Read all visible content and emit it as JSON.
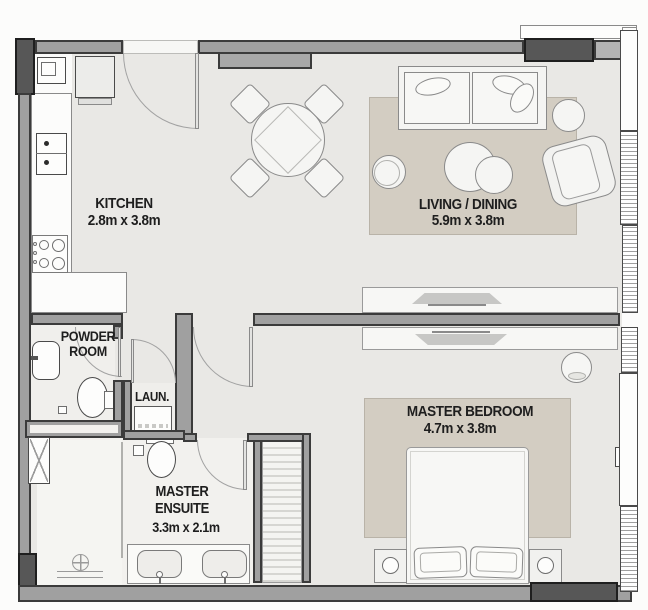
{
  "plan_title": "one-bedroom-apartment-floor-plan",
  "labels": {
    "kitchen": {
      "name": "KITCHEN",
      "dims": "2.8m x 3.8m"
    },
    "living_dining": {
      "name": "LIVING / DINING",
      "dims": "5.9m x 3.8m"
    },
    "powder_room": {
      "name_line1": "POWDER",
      "name_line2": "ROOM"
    },
    "laundry": {
      "name": "LAUN."
    },
    "master_ensuite": {
      "name_line1": "MASTER",
      "name_line2": "ENSUITE",
      "dims": "3.3m x 2.1m"
    },
    "master_bedroom": {
      "name": "MASTER BEDROOM",
      "dims": "4.7m x 3.8m"
    }
  },
  "colors": {
    "wall": "#a0a0a0",
    "wall_dark": "#575757",
    "wall_outline": "#3b3b3b",
    "floor": "#e9e8e5",
    "wet_floor": "#f2f1ee",
    "rug": "#d3cdc2",
    "label_text": "#1e1e1e"
  },
  "fixtures": [
    "entry-door",
    "kitchen-sink",
    "fridge",
    "oven",
    "cooktop",
    "dining-table",
    "dining-chairs",
    "sofa",
    "coffee-tables",
    "ottoman",
    "side-table",
    "armchair",
    "tv-living",
    "tv-bedroom",
    "media-console",
    "plant",
    "bed",
    "pillows",
    "nightstands",
    "lamps",
    "wardrobe",
    "washer",
    "powder-sink",
    "powder-toilet",
    "ensuite-toilet",
    "double-vanity",
    "shower-drain",
    "service-shaft",
    "windows",
    "balcony-edge"
  ]
}
